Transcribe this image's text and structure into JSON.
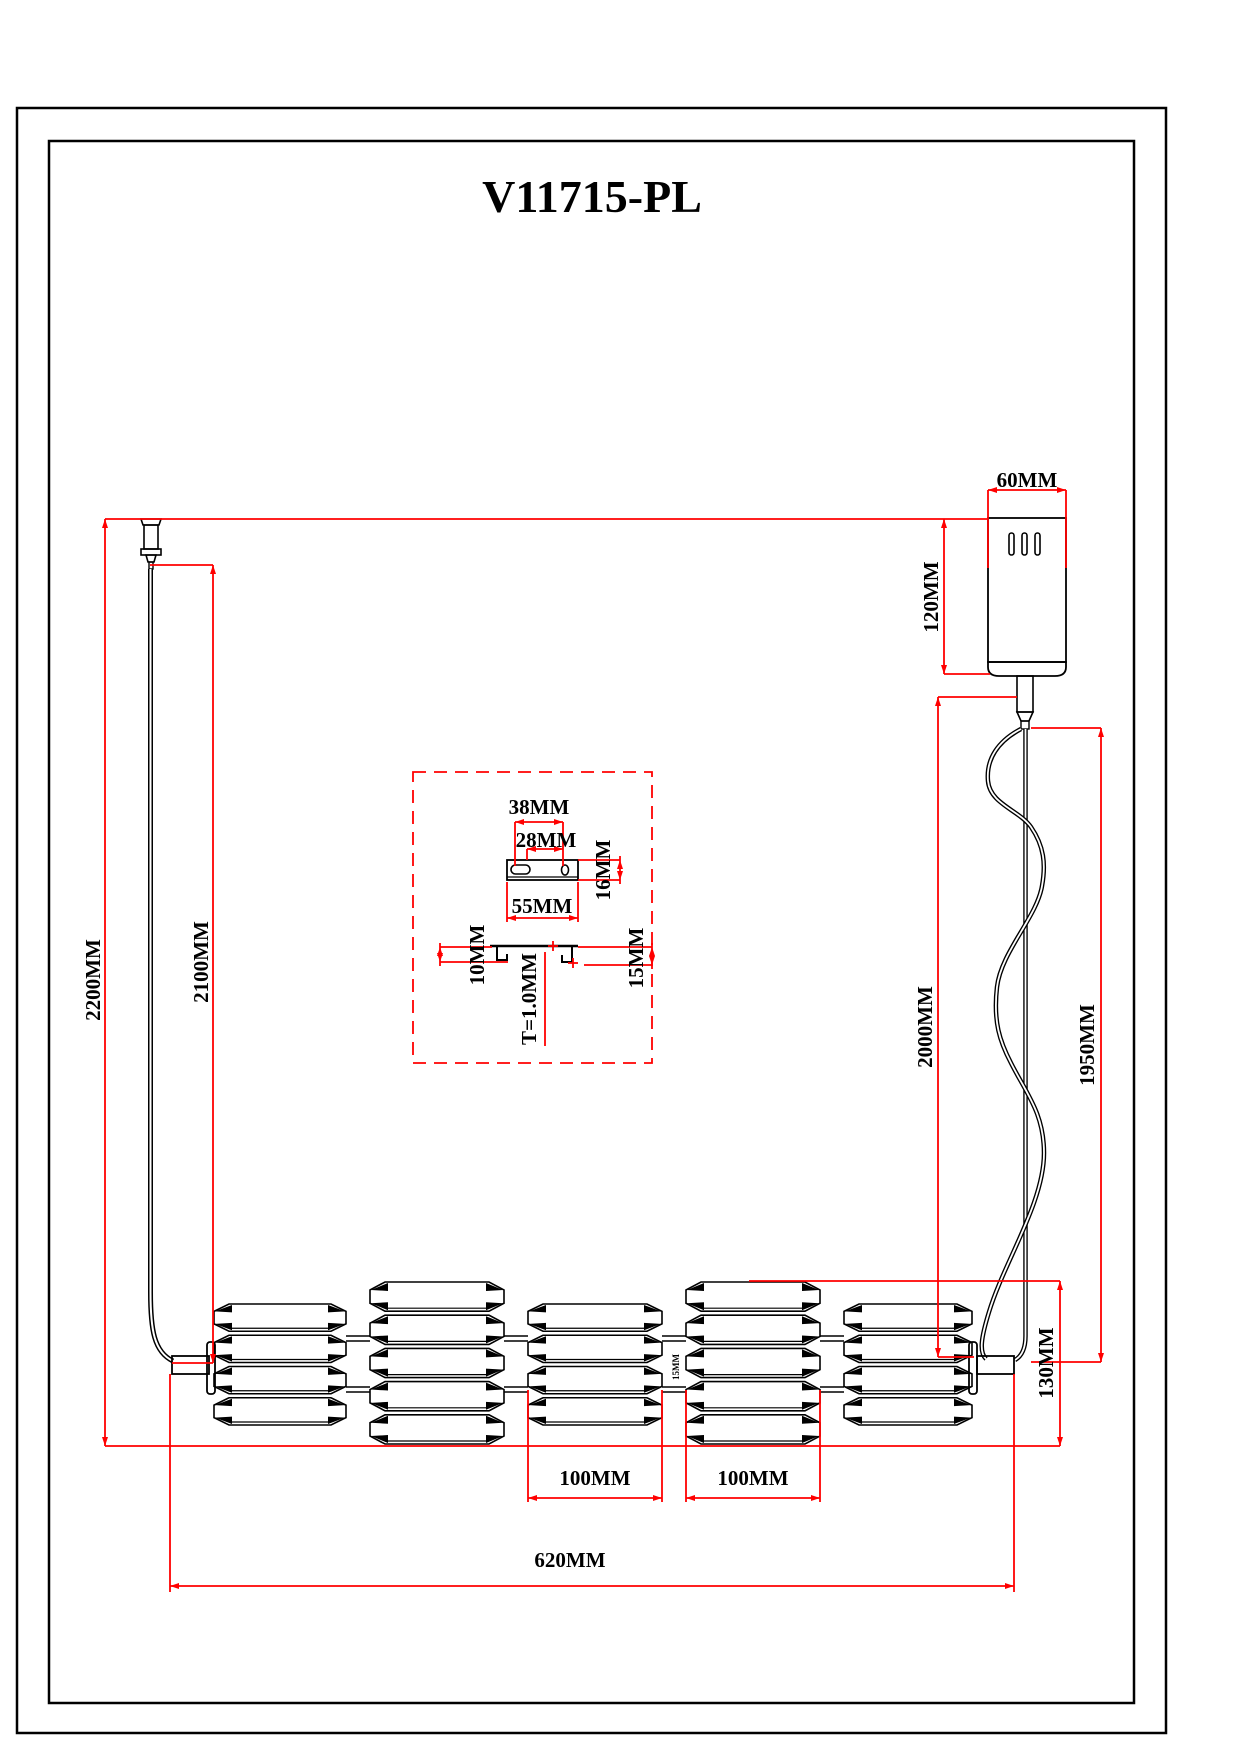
{
  "title": "V11715-PL",
  "dimensions": {
    "canopy_width": "60MM",
    "canopy_height": "120MM",
    "overall_drop": "2200MM",
    "wire_drop": "2100MM",
    "cable_drop_left": "2000MM",
    "cable_drop_right": "1950MM",
    "fixture_height": "130MM",
    "shade3_width": "100MM",
    "shade4_width": "100MM",
    "fixture_length": "620MM",
    "bracket_slot_span": "38MM",
    "bracket_hole_span": "28MM",
    "bracket_depth": "16MM",
    "bracket_length": "55MM",
    "bracket_lip_left": "10MM",
    "bracket_thickness": "T=1.0MM",
    "bracket_lip_right": "15MM",
    "shade_gap": "15MM"
  }
}
